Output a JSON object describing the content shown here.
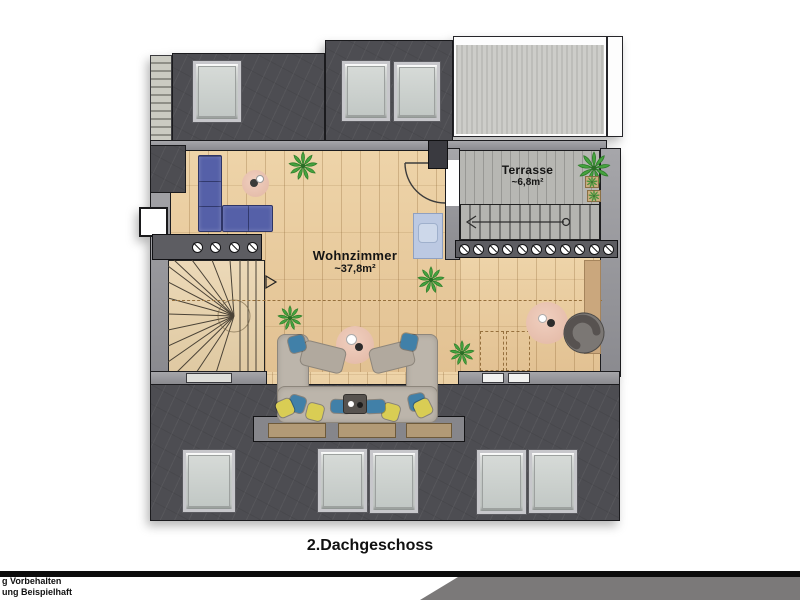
{
  "plan": {
    "floor_title": "2.Dachgeschoss",
    "rooms": [
      {
        "id": "wohnzimmer",
        "label": "Wohnzimmer",
        "area": "~37,8m²"
      },
      {
        "id": "terrasse",
        "label": "Terrasse",
        "area": "~6,8m²"
      }
    ],
    "symbols": {
      "railing_posts_terrace": 11,
      "railing_posts_stair_wall": 4,
      "skylights_top_row": 3,
      "skylights_bottom_row": 5
    }
  },
  "footer": {
    "disclaimer_line1": "g Vorbehalten",
    "disclaimer_line2": "ung Beispielhaft"
  },
  "colors": {
    "roof": "#4d4d52",
    "wall": "#8e8e93",
    "wood_floor": "#e7cba0",
    "terrace_deck": "#b7b7b3",
    "sofa_blue": "#5560a8",
    "sectional_gray": "#bcb5ab",
    "pillow_blue": "#4180a8",
    "pillow_yellow": "#d9cd54",
    "plant_green": "#45a33f",
    "rug_pink": "#eac4b3",
    "footer_gray": "#7b7979"
  }
}
